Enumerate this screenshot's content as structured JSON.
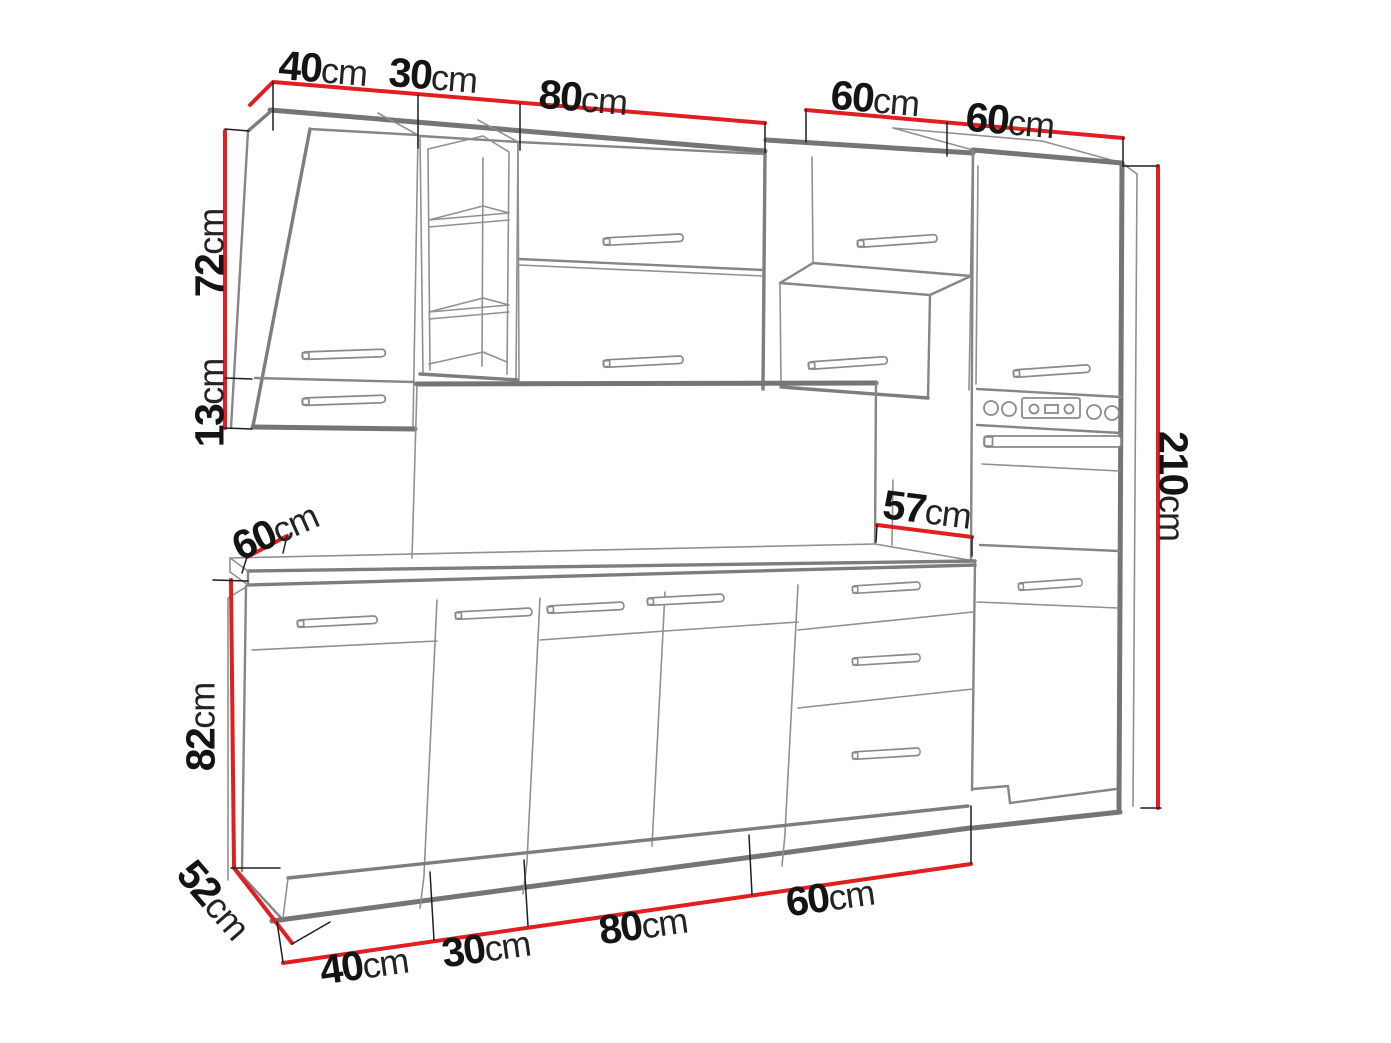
{
  "diagram": {
    "name": "kitchen-cabinet-set-dimension-diagram",
    "colors": {
      "dimension_red": "#e01f21",
      "structure_gray": "#868686",
      "label_black": "#141414",
      "background": "#ffffff"
    },
    "unit": "cm"
  },
  "dims": {
    "top_40": {
      "value": "40",
      "unit": "cm"
    },
    "top_30": {
      "value": "30",
      "unit": "cm"
    },
    "top_80": {
      "value": "80",
      "unit": "cm"
    },
    "top_60a": {
      "value": "60",
      "unit": "cm"
    },
    "top_60b": {
      "value": "60",
      "unit": "cm"
    },
    "left_72": {
      "value": "72",
      "unit": "cm"
    },
    "left_13": {
      "value": "13",
      "unit": "cm"
    },
    "counter_depth_60": {
      "value": "60",
      "unit": "cm"
    },
    "splash_57": {
      "value": "57",
      "unit": "cm"
    },
    "right_210": {
      "value": "210",
      "unit": "cm"
    },
    "left_82": {
      "value": "82",
      "unit": "cm"
    },
    "base_depth_52": {
      "value": "52",
      "unit": "cm"
    },
    "bottom_40": {
      "value": "40",
      "unit": "cm"
    },
    "bottom_30": {
      "value": "30",
      "unit": "cm"
    },
    "bottom_80": {
      "value": "80",
      "unit": "cm"
    },
    "bottom_60": {
      "value": "60",
      "unit": "cm"
    }
  }
}
